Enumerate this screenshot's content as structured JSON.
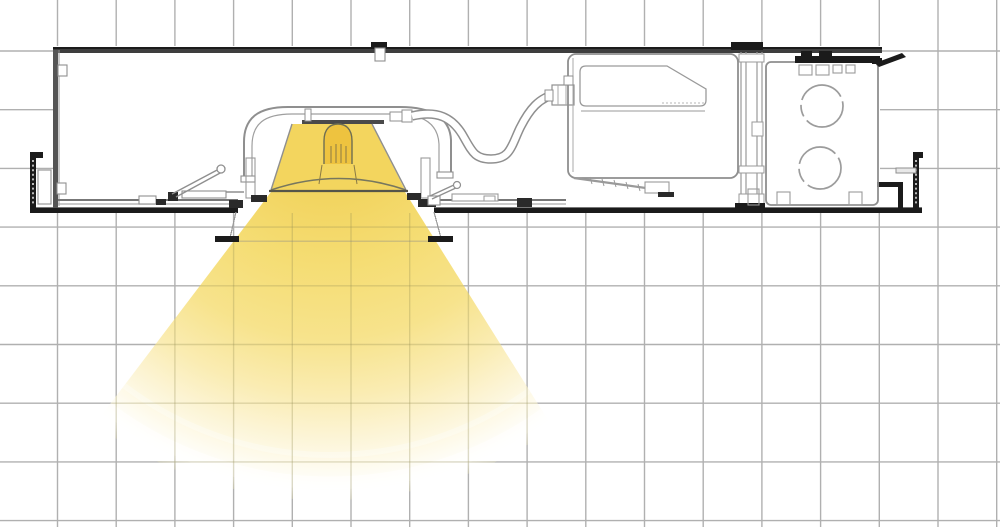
{
  "meta": {
    "description": "Cross-section technical line drawing of a recessed downlight fixture installed in a ceiling, with plaster frame, torsion springs, flexible conduit, driver compartment and junction box with two knockout circles, projecting a yellow light beam cone downward over a square grid background.",
    "text_content": "none"
  },
  "canvas": {
    "width": 1000,
    "height": 527,
    "background": "#ffffff"
  },
  "grid": {
    "step": 58.7,
    "origin_x": 57.5,
    "origin_y": 51,
    "color": "#b0b0b0",
    "stroke_width": 1.4,
    "beam_overlay_color": "#968e54",
    "beam_overlay_opacity": 0.3
  },
  "palette": {
    "paper": "#ffffff",
    "line_light": "#9a9a9a",
    "line_mid": "#6e6e6e",
    "line_dark": "#3e3e3e",
    "black": "#1b1b1b",
    "beam_core": "#eec94c",
    "beam_mid": "#f6e189",
    "beam_pale": "#fbf1c9",
    "beam_white": "#ffffff"
  },
  "beam": {
    "apex": {
      "x": 330,
      "y": 115
    },
    "radius": 400,
    "opacity": 1,
    "gradient_stops": [
      {
        "offset": 0,
        "color": "#eec94c",
        "opacity": 1
      },
      {
        "offset": 0.2,
        "color": "#f2d45f",
        "opacity": 1
      },
      {
        "offset": 0.38,
        "color": "#f5dd74",
        "opacity": 1
      },
      {
        "offset": 0.56,
        "color": "#f7e38c",
        "opacity": 1
      },
      {
        "offset": 0.7,
        "color": "#faecb2",
        "opacity": 1
      },
      {
        "offset": 0.8,
        "color": "#fcf4d4",
        "opacity": 1
      },
      {
        "offset": 0.88,
        "color": "#fefbee",
        "opacity": 1
      },
      {
        "offset": 0.94,
        "color": "#ffffff",
        "opacity": 0.8
      },
      {
        "offset": 1,
        "color": "#ffffff",
        "opacity": 0
      }
    ],
    "rings": [
      {
        "r": 340,
        "color": "#ffffff",
        "width": 6,
        "opacity": 0.3
      },
      {
        "r": 368,
        "color": "#ffffff",
        "width": 13,
        "opacity": 0.55
      },
      {
        "r": 391,
        "color": "#d7d7d0",
        "width": 3,
        "opacity": 0.65
      }
    ]
  },
  "components": [
    "background-grid",
    "recessed-housing-frame",
    "hanger-bar-rail",
    "hanger-bar-left-end",
    "hanger-bar-right-end",
    "ceiling-line",
    "ceiling-aperture-trim",
    "torsion-spring-left",
    "torsion-spring-right",
    "lamp-housing-arch",
    "led-lamp-module",
    "reflector",
    "flex-conduit",
    "conduit-connector",
    "driver-compartment",
    "led-driver",
    "compartment-divider",
    "junction-box",
    "knockout-circle-upper",
    "knockout-circle-lower",
    "junction-box-ears",
    "light-beam-cone",
    "light-beam-rings"
  ]
}
